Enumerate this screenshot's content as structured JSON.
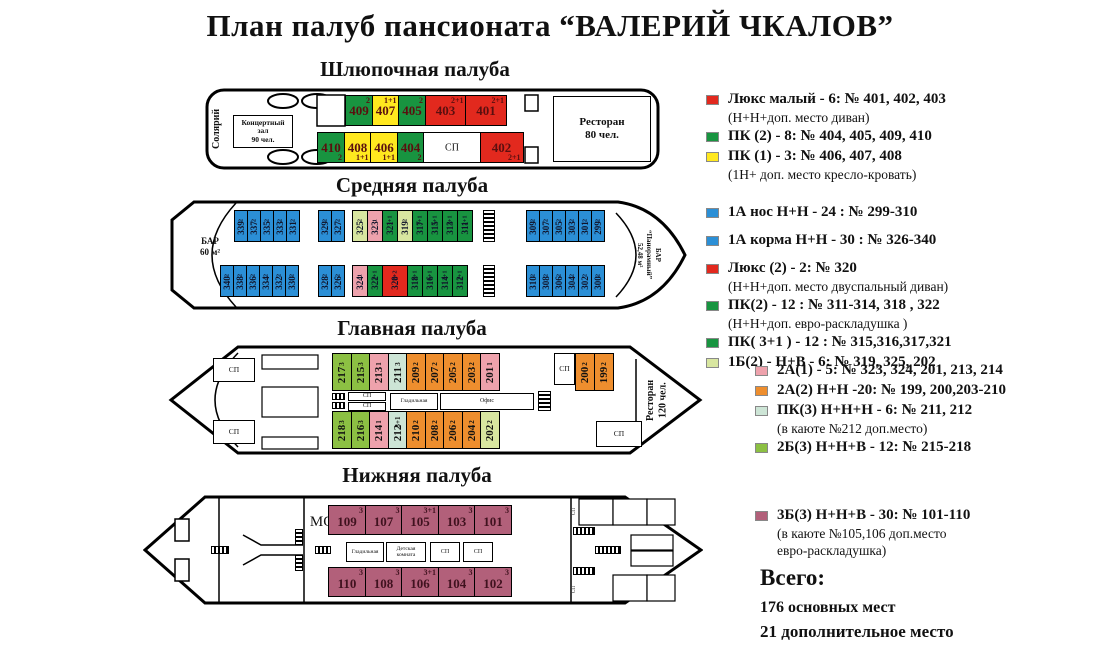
{
  "title": "План палуб пансионата  “ВАЛЕРИЙ ЧКАЛОВ”",
  "colors": {
    "red": "#e2291e",
    "green": "#189440",
    "yellow": "#ffe81f",
    "blue": "#2b8fd6",
    "ltgreen": "#d8e6a0",
    "pink": "#eea2ac",
    "orange": "#ee8e2e",
    "mint": "#cde5d6",
    "ygreen": "#8cc043",
    "maroon": "#b2607a",
    "white": "#ffffff"
  },
  "labels": {
    "sp": "СП",
    "mo": "МО",
    "solarium": "Солярий",
    "concert_hall": "Концертный\nзал\n90 чел.",
    "restaurant_80": "Ресторан\n80 чел.",
    "restaurant_120": "Ресторан\n120 чел.",
    "bar_60": "БАР\n60 м²",
    "bar_panoramic": "БАР\n“Панорамный”\n52,48 м²",
    "ironing": "Гладильная",
    "office": "Офис",
    "kids_room": "Детская\nкомната"
  },
  "decks": {
    "boat": {
      "title": "Шлюпочная палуба",
      "top": [
        {
          "n": "409",
          "c": "2",
          "k": "green"
        },
        {
          "n": "407",
          "c": "1+1",
          "k": "yellow"
        },
        {
          "n": "405",
          "c": "2",
          "k": "green"
        },
        {
          "n": "403",
          "c": "2+1",
          "k": "red",
          "w": 42
        },
        {
          "n": "401",
          "c": "2+1",
          "k": "red",
          "w": 42
        }
      ],
      "bottom": [
        {
          "n": "410",
          "c": "2",
          "k": "green"
        },
        {
          "n": "408",
          "c": "1+1",
          "k": "yellow"
        },
        {
          "n": "406",
          "c": "1+1",
          "k": "yellow"
        },
        {
          "n": "404",
          "c": "2",
          "k": "green"
        },
        {
          "n": "СП",
          "k": "white",
          "w": 58,
          "s": true
        },
        {
          "n": "402",
          "c": "2+1",
          "k": "red",
          "w": 44
        }
      ]
    },
    "middle": {
      "title": "Средняя палуба",
      "top_left": [
        "339",
        "337",
        "335",
        "333",
        "331"
      ],
      "top_left2": [
        "329",
        "327"
      ],
      "top_mid": [
        {
          "n": "325",
          "c": "2",
          "k": "ltgreen"
        },
        {
          "n": "323",
          "c": "1",
          "k": "pink"
        },
        {
          "n": "321",
          "c": "3+1",
          "k": "green"
        },
        {
          "n": "319",
          "c": "2",
          "k": "ltgreen"
        },
        {
          "n": "317",
          "c": "3+1",
          "k": "green"
        },
        {
          "n": "315",
          "c": "3+1",
          "k": "green"
        },
        {
          "n": "313",
          "c": "2+1",
          "k": "green"
        },
        {
          "n": "311",
          "c": "2+1",
          "k": "green"
        }
      ],
      "top_right": [
        "309",
        "307",
        "305",
        "303",
        "301",
        "299"
      ],
      "bottom_left": [
        "340",
        "338",
        "336",
        "334",
        "332",
        "330"
      ],
      "bottom_left2": [
        "328",
        "326"
      ],
      "bottom_mid": [
        {
          "n": "324",
          "c": "1",
          "k": "pink"
        },
        {
          "n": "322",
          "c": "2+1",
          "k": "green"
        },
        {
          "n": "320",
          "c": "2+2",
          "k": "red",
          "w": 26
        },
        {
          "n": "318",
          "c": "2+1",
          "k": "green"
        },
        {
          "n": "316",
          "c": "3+1",
          "k": "green"
        },
        {
          "n": "314",
          "c": "2+1",
          "k": "green"
        },
        {
          "n": "312",
          "c": "2+1",
          "k": "green"
        }
      ],
      "bottom_right": [
        "310",
        "308",
        "306",
        "304",
        "302",
        "300"
      ]
    },
    "main": {
      "title": "Главная палуба",
      "top": [
        {
          "n": "217",
          "c": "3",
          "k": "ygreen"
        },
        {
          "n": "215",
          "c": "3",
          "k": "ygreen"
        },
        {
          "n": "213",
          "c": "1",
          "k": "pink"
        },
        {
          "n": "211",
          "c": "3",
          "k": "mint"
        },
        {
          "n": "209",
          "c": "2",
          "k": "orange"
        },
        {
          "n": "207",
          "c": "2",
          "k": "orange"
        },
        {
          "n": "205",
          "c": "2",
          "k": "orange"
        },
        {
          "n": "203",
          "c": "2",
          "k": "orange"
        },
        {
          "n": "201",
          "c": "1",
          "k": "pink"
        }
      ],
      "bottom": [
        {
          "n": "218",
          "c": "3",
          "k": "ygreen"
        },
        {
          "n": "216",
          "c": "3",
          "k": "ygreen"
        },
        {
          "n": "214",
          "c": "1",
          "k": "pink"
        },
        {
          "n": "212",
          "c": "3+1",
          "k": "mint"
        },
        {
          "n": "210",
          "c": "2",
          "k": "orange"
        },
        {
          "n": "208",
          "c": "2",
          "k": "orange"
        },
        {
          "n": "206",
          "c": "2",
          "k": "orange"
        },
        {
          "n": "204",
          "c": "2",
          "k": "orange"
        },
        {
          "n": "202",
          "c": "2",
          "k": "ltgreen"
        }
      ],
      "right": [
        {
          "n": "200",
          "c": "2",
          "k": "orange"
        },
        {
          "n": "199",
          "c": "2",
          "k": "orange"
        }
      ]
    },
    "lower": {
      "title": "Нижняя палуба",
      "top": [
        {
          "n": "109",
          "c": "3",
          "k": "maroon"
        },
        {
          "n": "107",
          "c": "3",
          "k": "maroon"
        },
        {
          "n": "105",
          "c": "3+1",
          "k": "maroon"
        },
        {
          "n": "103",
          "c": "3",
          "k": "maroon"
        },
        {
          "n": "101",
          "c": "3",
          "k": "maroon"
        }
      ],
      "bottom": [
        {
          "n": "110",
          "c": "3",
          "k": "maroon"
        },
        {
          "n": "108",
          "c": "3",
          "k": "maroon"
        },
        {
          "n": "106",
          "c": "3+1",
          "k": "maroon"
        },
        {
          "n": "104",
          "c": "3",
          "k": "maroon"
        },
        {
          "n": "102",
          "c": "3",
          "k": "maroon"
        }
      ]
    }
  },
  "legend": {
    "groups": [
      {
        "items": [
          {
            "color": "red",
            "text": "Люкс малый - 6: № 401, 402, 403",
            "notes": [
              "(Н+Н+доп. место диван)"
            ]
          },
          {
            "color": "green",
            "text": "ПК (2) - 8: № 404, 405, 409, 410"
          },
          {
            "color": "yellow",
            "text": "ПК (1) - 3: № 406, 407, 408",
            "notes": [
              "(1Н+ доп. место кресло-кровать)"
            ]
          }
        ]
      },
      {
        "items": [
          {
            "color": "blue",
            "text": "1А нос  Н+Н - 24 : № 299-310",
            "gap": true
          },
          {
            "color": "blue",
            "text": "1А корма  Н+Н - 30 : № 326-340",
            "gap": true
          },
          {
            "color": "red",
            "text": "Люкс (2)  - 2: № 320",
            "notes": [
              "(Н+Н+доп. место двуспальный диван)"
            ]
          },
          {
            "color": "green",
            "text": "ПК(2) - 12 : № 311-314, 318 , 322",
            "notes": [
              "(Н+Н+доп.  евро-раскладушка )"
            ]
          },
          {
            "color": "green",
            "text": "ПК( 3+1 ) - 12 : № 315,316,317,321"
          },
          {
            "color": "ltgreen",
            "text": "1Б(2) - Н+В - 6: № 319, 325, 202"
          }
        ]
      },
      {
        "items": [
          {
            "color": "pink",
            "text": "2А(1) - 5: № 323, 324, 201, 213, 214"
          },
          {
            "color": "orange",
            "text": "2А(2) Н+Н -20: № 199, 200,203-210"
          },
          {
            "color": "mint",
            "text": "ПК(3) Н+Н+Н - 6: № 211, 212",
            "notes": [
              "(в каюте №212 доп.место)"
            ]
          },
          {
            "color": "ygreen",
            "text": "2Б(3) Н+Н+В - 12: № 215-218"
          }
        ]
      },
      {
        "items": [
          {
            "color": "maroon",
            "text": "3Б(3) Н+Н+В - 30: № 101-110",
            "notes": [
              "(в каюте №105,106 доп.место",
              "евро-раскладушка)"
            ]
          }
        ]
      }
    ],
    "totals": {
      "heading": "Всего:",
      "line1": "176 основных мест",
      "line2": "21 дополнительное место"
    }
  }
}
